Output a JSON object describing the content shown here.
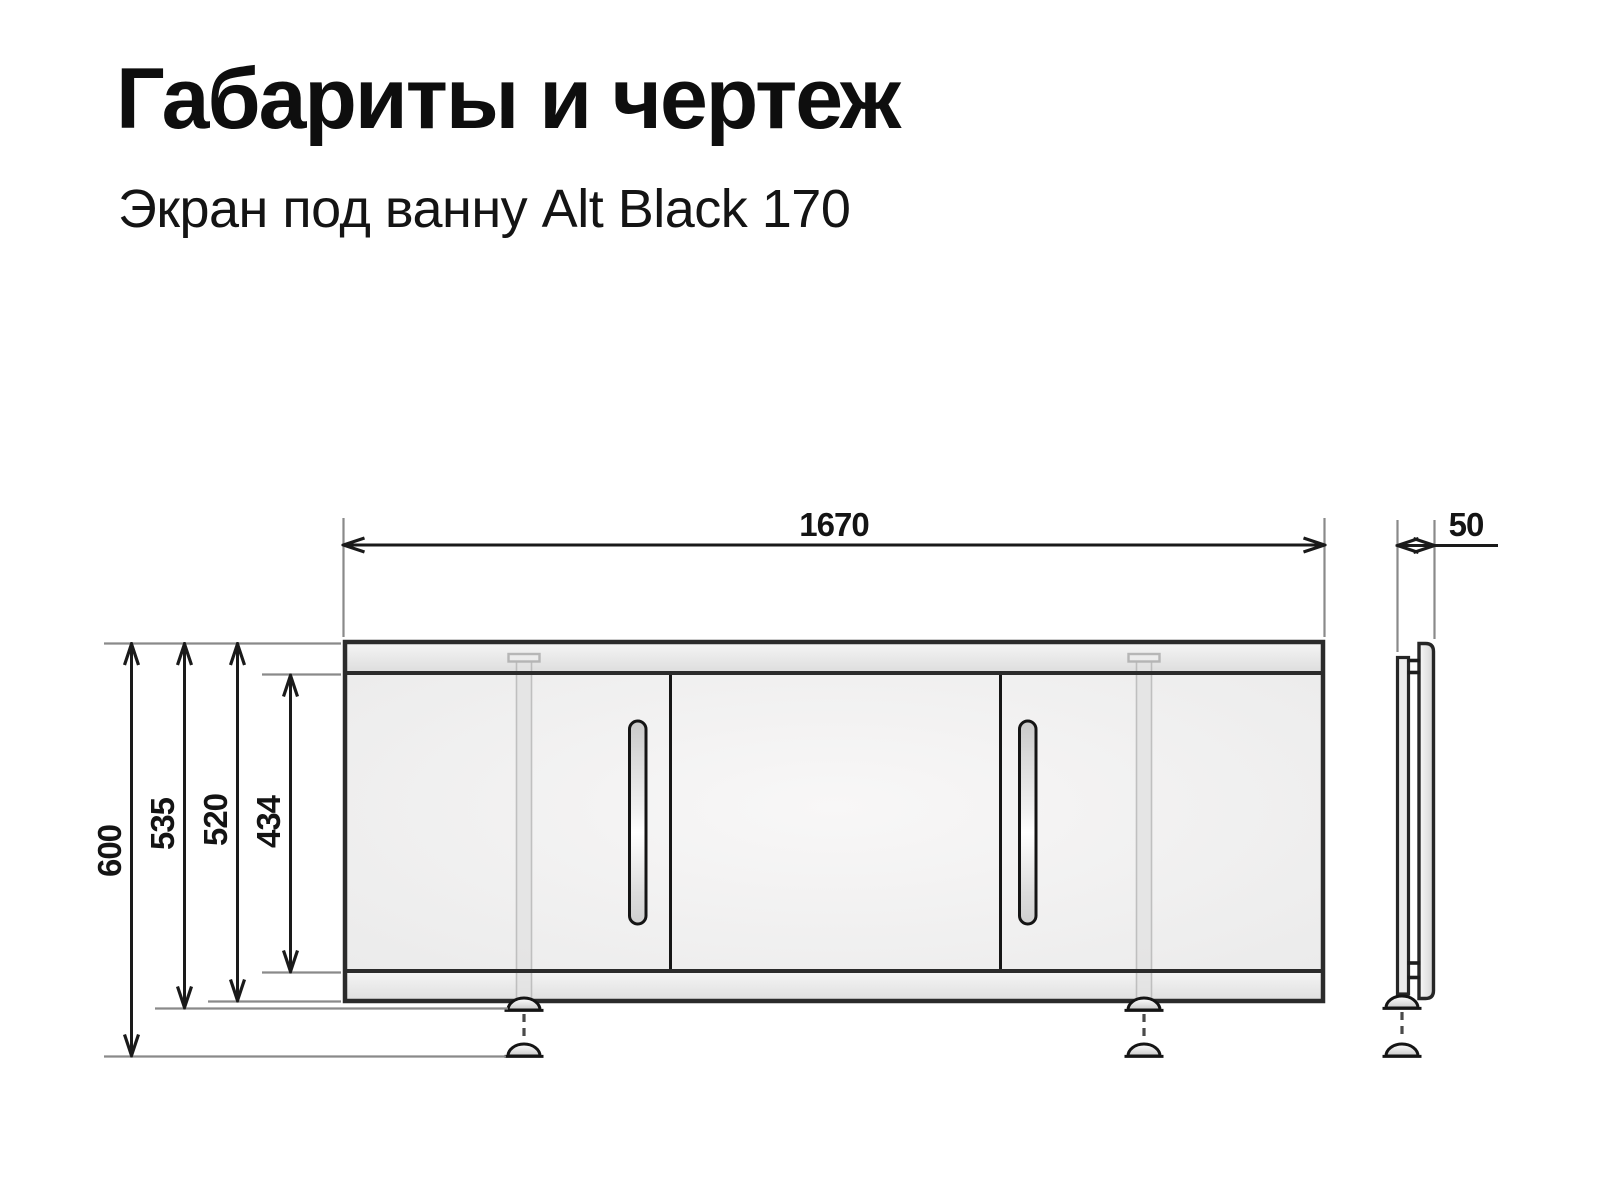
{
  "page": {
    "title": "Габариты и чертеж",
    "subtitle": "Экран под ванну Alt Black 170"
  },
  "dimensions": {
    "front": {
      "width": "1670",
      "height_total": "600",
      "height_with_feet": "535",
      "height_panel": "520",
      "height_doors": "434"
    },
    "side": {
      "depth": "50"
    }
  },
  "colors": {
    "background": "#ffffff",
    "outline": "#2b2b2b",
    "dimension_line": "#1a1a1a",
    "extension_line": "#8a8a8a",
    "text": "#141414"
  }
}
